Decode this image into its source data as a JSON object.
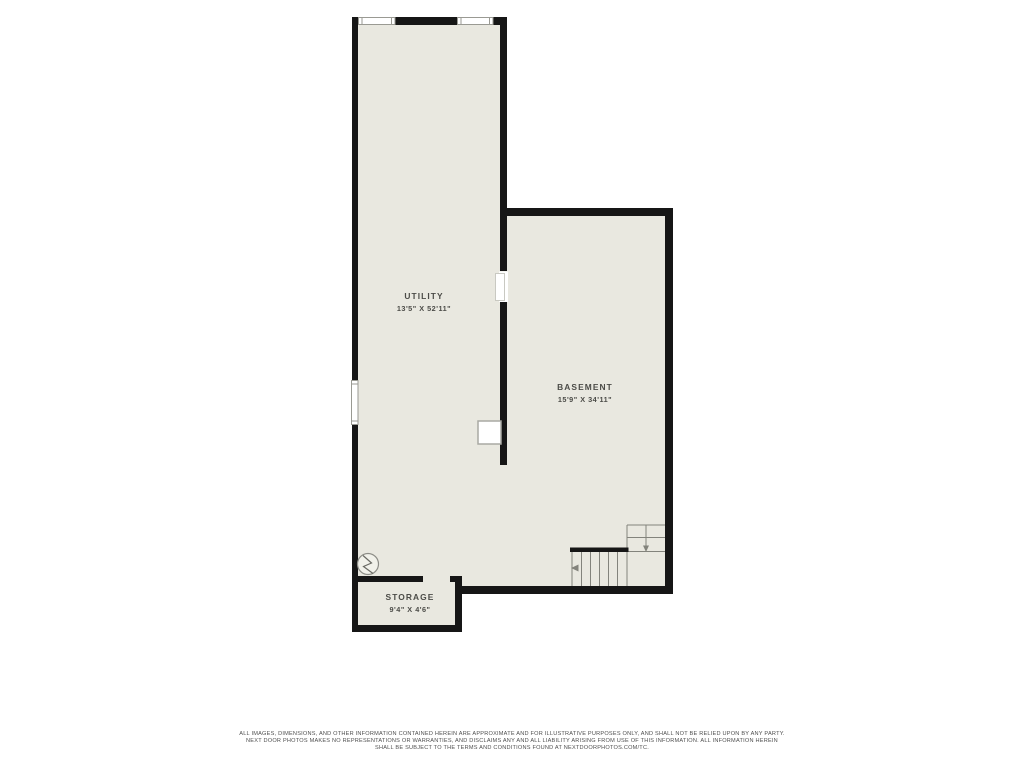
{
  "plan": {
    "type": "floor-plan",
    "colors": {
      "floor": "#e9e8e0",
      "wall": "#161616",
      "fixture_stroke": "#9a9a93",
      "stair_stroke": "#83837c",
      "label_text": "#4b4b47"
    },
    "rooms": [
      {
        "name": "UTILITY",
        "dimensions": "13'5\" X 52'11\""
      },
      {
        "name": "BASEMENT",
        "dimensions": "15'9\" X 34'11\""
      },
      {
        "name": "STORAGE",
        "dimensions": "9'4\" X 4'6\""
      }
    ],
    "fixtures": [
      "window-top-left",
      "window-top-right",
      "window-left",
      "door-opening-basement",
      "door-opening-storage",
      "electrical-panel",
      "water-heater",
      "staircase-l-shaped"
    ]
  },
  "footer": {
    "disclaimer_lines": [
      "ALL IMAGES, DIMENSIONS, AND OTHER INFORMATION CONTAINED HEREIN ARE APPROXIMATE AND FOR ILLUSTRATIVE PURPOSES ONLY, AND SHALL NOT BE RELIED UPON BY ANY PARTY.",
      "NEXT DOOR PHOTOS MAKES NO REPRESENTATIONS OR WARRANTIES, AND DISCLAIMS ANY AND ALL LIABILITY ARISING FROM USE OF THIS INFORMATION. ALL INFORMATION HEREIN",
      "SHALL BE SUBJECT TO THE TERMS AND CONDITIONS FOUND AT NEXTDOORPHOTOS.COM/TC."
    ]
  }
}
